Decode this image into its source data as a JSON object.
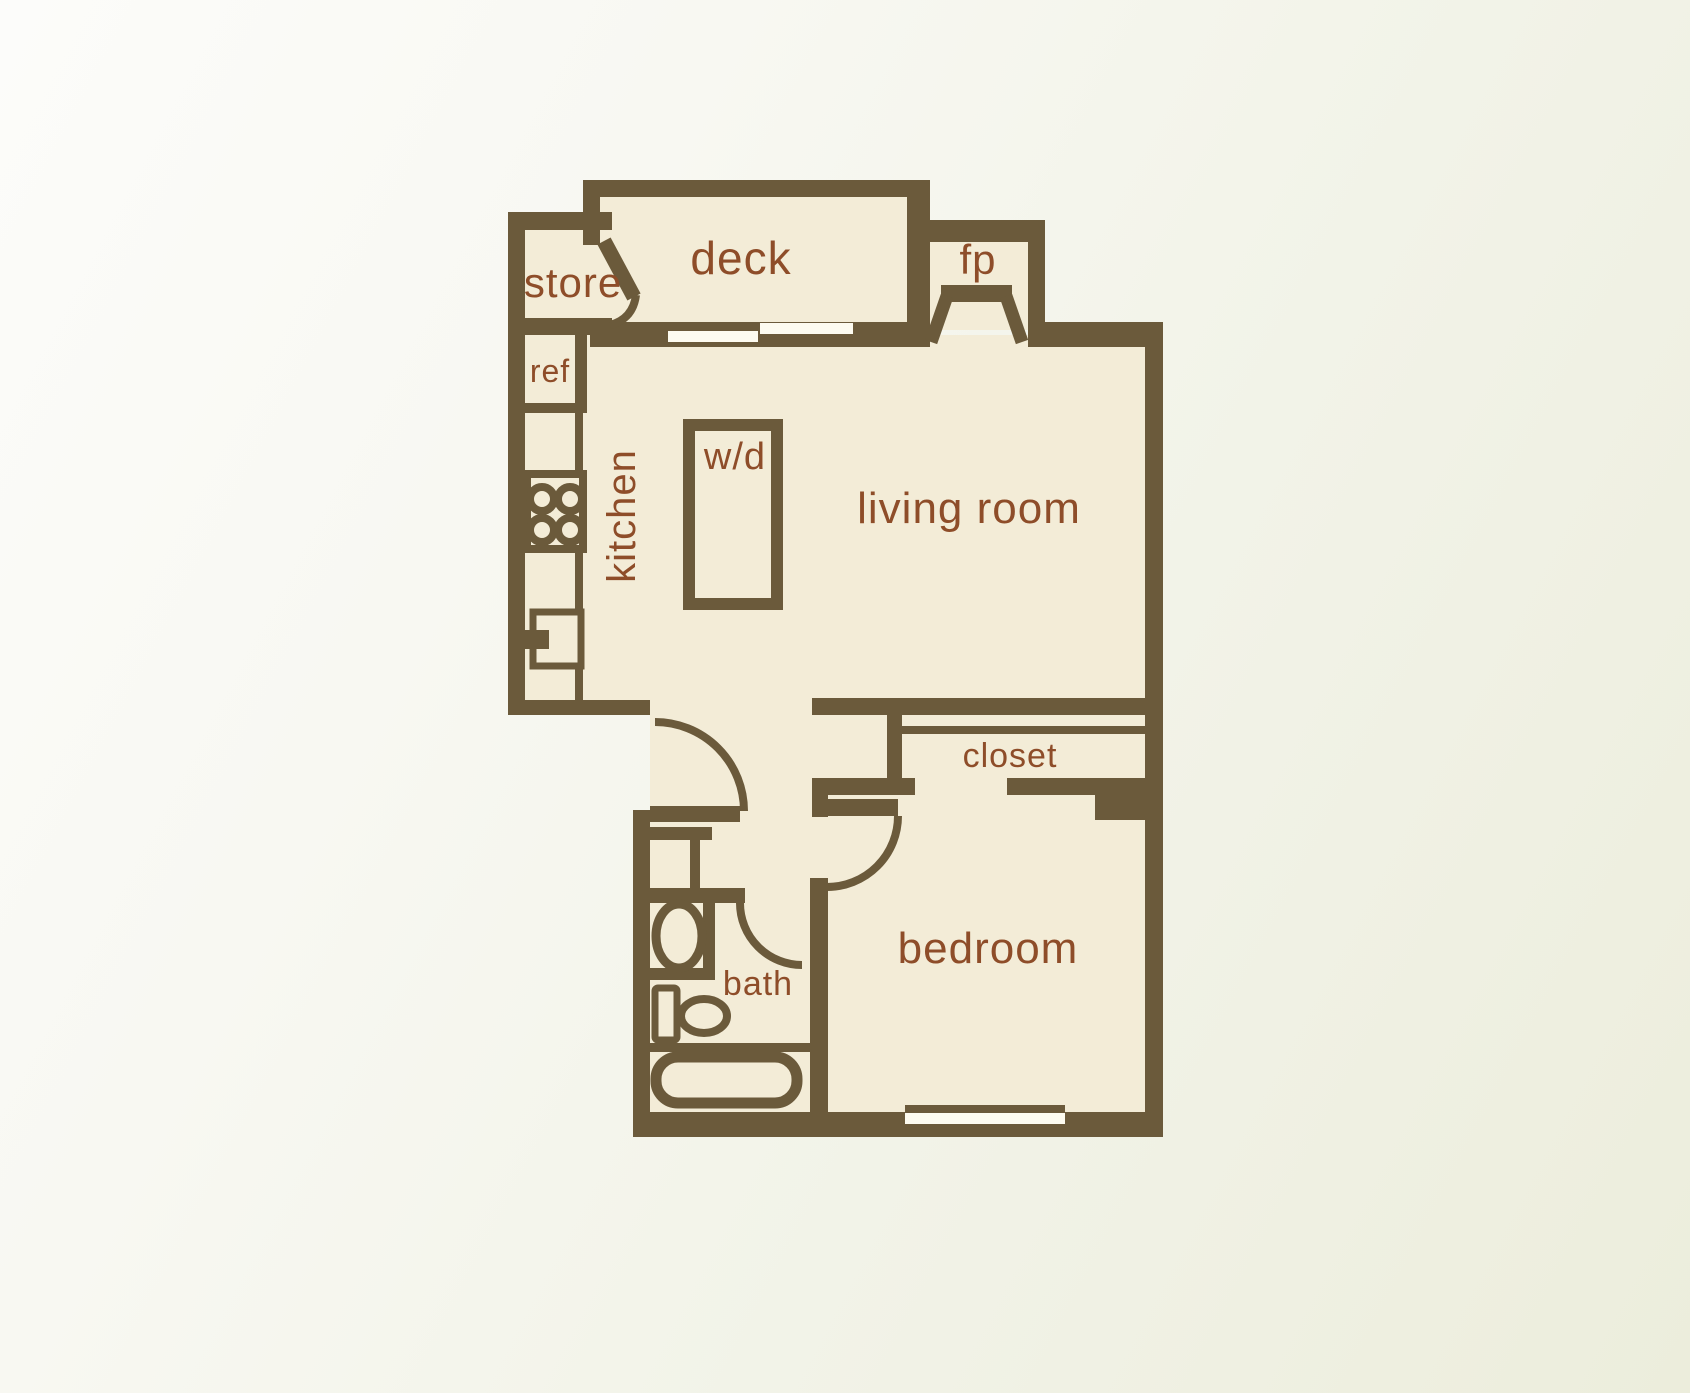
{
  "title": "one-bedroom apartment floor plan",
  "palette": {
    "wall": "#6b5a3b",
    "floor": "#f3ecd7",
    "label": "#8e4d29",
    "slit": "#fdfbf0",
    "bg_start": "#fcfcfa",
    "bg_end": "#eceddc"
  },
  "canvas": {
    "width": 1690,
    "height": 1393
  },
  "rooms": [
    {
      "id": "label-store",
      "text": "store",
      "x": 573,
      "y": 297,
      "fs": 42,
      "rot": 0
    },
    {
      "id": "label-deck",
      "text": "deck",
      "x": 741,
      "y": 274,
      "fs": 46,
      "rot": 0
    },
    {
      "id": "label-fp",
      "text": "fp",
      "x": 978,
      "y": 274,
      "fs": 42,
      "rot": 0
    },
    {
      "id": "label-ref",
      "text": "ref",
      "x": 550,
      "y": 382,
      "fs": 32,
      "rot": 0
    },
    {
      "id": "label-kitchen",
      "text": "kitchen",
      "x": 635,
      "y": 516,
      "fs": 40,
      "rot": -90
    },
    {
      "id": "label-wd",
      "text": "w/d",
      "x": 735,
      "y": 469,
      "fs": 38,
      "rot": 0
    },
    {
      "id": "label-living-room",
      "text": "living room",
      "x": 969,
      "y": 523,
      "fs": 44,
      "rot": 0
    },
    {
      "id": "label-closet",
      "text": "closet",
      "x": 1010,
      "y": 767,
      "fs": 34,
      "rot": 0
    },
    {
      "id": "label-bedroom",
      "text": "bedroom",
      "x": 988,
      "y": 963,
      "fs": 44,
      "rot": 0
    },
    {
      "id": "label-bath",
      "text": "bath",
      "x": 758,
      "y": 995,
      "fs": 34,
      "rot": 0
    }
  ],
  "floors": [
    {
      "id": "deck-floor",
      "x": 595,
      "y": 190,
      "w": 320,
      "h": 140
    },
    {
      "id": "store-floor",
      "x": 518,
      "y": 222,
      "w": 94,
      "h": 108
    },
    {
      "id": "kitchen-column-floor",
      "x": 518,
      "y": 325,
      "w": 65,
      "h": 385
    },
    {
      "id": "fireplace-floor",
      "x": 920,
      "y": 232,
      "w": 115,
      "h": 98
    },
    {
      "id": "main-floor",
      "x": 583,
      "y": 335,
      "w": 570,
      "h": 373
    },
    {
      "id": "hall-bath-floor",
      "x": 650,
      "y": 708,
      "w": 170,
      "h": 412
    },
    {
      "id": "bedroom-floor",
      "x": 818,
      "y": 708,
      "w": 335,
      "h": 412
    },
    {
      "id": "door-nook-floor",
      "x": 808,
      "y": 817,
      "w": 24,
      "h": 62
    }
  ],
  "walls": [
    {
      "id": "wall-left",
      "x": 508,
      "y": 212,
      "w": 17,
      "h": 503
    },
    {
      "id": "wall-store-top",
      "x": 508,
      "y": 212,
      "w": 104,
      "h": 18
    },
    {
      "id": "wall-store-bottom",
      "x": 508,
      "y": 318,
      "w": 104,
      "h": 17
    },
    {
      "id": "wall-ref-right",
      "x": 575,
      "y": 318,
      "w": 12,
      "h": 95
    },
    {
      "id": "wall-ref-bottom",
      "x": 508,
      "y": 403,
      "w": 79,
      "h": 10
    },
    {
      "id": "counter-edge",
      "x": 575,
      "y": 413,
      "w": 8,
      "h": 292
    },
    {
      "id": "wall-kitchen-bottom",
      "x": 508,
      "y": 700,
      "w": 142,
      "h": 15
    },
    {
      "id": "wall-deck-top",
      "x": 583,
      "y": 180,
      "w": 347,
      "h": 17
    },
    {
      "id": "wall-deck-left",
      "x": 583,
      "y": 180,
      "w": 17,
      "h": 65
    },
    {
      "id": "wall-deck-right",
      "x": 907,
      "y": 197,
      "w": 23,
      "h": 150
    },
    {
      "id": "wall-slider",
      "x": 590,
      "y": 322,
      "w": 340,
      "h": 25
    },
    {
      "id": "wall-fireplace-top",
      "x": 907,
      "y": 220,
      "w": 138,
      "h": 22
    },
    {
      "id": "wall-fireplace-right",
      "x": 1028,
      "y": 242,
      "w": 17,
      "h": 105
    },
    {
      "id": "wall-top-right",
      "x": 1028,
      "y": 322,
      "w": 135,
      "h": 25
    },
    {
      "id": "wall-right",
      "x": 1145,
      "y": 322,
      "w": 18,
      "h": 815
    },
    {
      "id": "wall-livingroom-bottom",
      "x": 812,
      "y": 698,
      "w": 351,
      "h": 17
    },
    {
      "id": "wall-closet-left-end",
      "x": 887,
      "y": 715,
      "w": 15,
      "h": 80
    },
    {
      "id": "closet-track",
      "x": 902,
      "y": 726,
      "w": 243,
      "h": 8
    },
    {
      "id": "wall-closet-bottom-left",
      "x": 812,
      "y": 778,
      "w": 103,
      "h": 17
    },
    {
      "id": "wall-closet-left-tab",
      "x": 812,
      "y": 795,
      "w": 16,
      "h": 22
    },
    {
      "id": "wall-closet-bottom-right",
      "x": 1007,
      "y": 778,
      "w": 140,
      "h": 17
    },
    {
      "id": "wall-closet-end-block",
      "x": 1095,
      "y": 778,
      "w": 52,
      "h": 42
    },
    {
      "id": "bedroom-door-leaf",
      "x": 826,
      "y": 799,
      "w": 72,
      "h": 17
    },
    {
      "id": "wall-bedroom-left",
      "x": 810,
      "y": 878,
      "w": 18,
      "h": 259
    },
    {
      "id": "wall-bath-left",
      "x": 633,
      "y": 810,
      "w": 17,
      "h": 327
    },
    {
      "id": "wall-bath-top",
      "x": 650,
      "y": 806,
      "w": 90,
      "h": 16
    },
    {
      "id": "vanity-counter-top",
      "x": 650,
      "y": 827,
      "w": 62,
      "h": 13
    },
    {
      "id": "vanity-divider",
      "x": 690,
      "y": 840,
      "w": 10,
      "h": 50
    },
    {
      "id": "wall-bath-mid",
      "x": 650,
      "y": 888,
      "w": 95,
      "h": 15
    },
    {
      "id": "vanity-right",
      "x": 703,
      "y": 903,
      "w": 12,
      "h": 75
    },
    {
      "id": "vanity-bottom",
      "x": 650,
      "y": 968,
      "w": 65,
      "h": 12
    },
    {
      "id": "toilet-divider",
      "x": 648,
      "y": 1043,
      "w": 162,
      "h": 9
    },
    {
      "id": "wall-bottom",
      "x": 633,
      "y": 1112,
      "w": 530,
      "h": 25
    },
    {
      "id": "window-inner-line",
      "x": 905,
      "y": 1105,
      "w": 160,
      "h": 8
    }
  ],
  "slits": [
    {
      "id": "slider-panel-1",
      "x": 668,
      "y": 331,
      "w": 90,
      "h": 11
    },
    {
      "id": "slider-panel-2",
      "x": 760,
      "y": 323,
      "w": 93,
      "h": 11
    },
    {
      "id": "bedroom-window",
      "x": 905,
      "y": 1113,
      "w": 160,
      "h": 11
    }
  ],
  "stroked_boxes": [
    {
      "id": "stove-box",
      "x": 527,
      "y": 474,
      "w": 56,
      "h": 75,
      "sw": 8,
      "rx": 0
    },
    {
      "id": "kitchen-sink-box",
      "x": 533,
      "y": 612,
      "w": 48,
      "h": 54,
      "sw": 7,
      "rx": 0
    },
    {
      "id": "washer-dryer-box",
      "x": 689,
      "y": 425,
      "w": 88,
      "h": 179,
      "sw": 12,
      "rx": 0
    },
    {
      "id": "toilet-tank",
      "x": 655,
      "y": 988,
      "w": 22,
      "h": 52,
      "sw": 7,
      "rx": 3
    },
    {
      "id": "bathtub",
      "x": 656,
      "y": 1057,
      "w": 141,
      "h": 46,
      "sw": 11,
      "rx": 22
    }
  ],
  "filled_rects": [
    {
      "id": "sink-faucet",
      "x": 521,
      "y": 630,
      "w": 28,
      "h": 19
    }
  ],
  "burners": [
    {
      "id": "stove-burner-1",
      "cx": 542,
      "cy": 499,
      "r": 12
    },
    {
      "id": "stove-burner-2",
      "cx": 570,
      "cy": 499,
      "r": 12
    },
    {
      "id": "stove-burner-3",
      "cx": 542,
      "cy": 530,
      "r": 12
    },
    {
      "id": "stove-burner-4",
      "cx": 570,
      "cy": 530,
      "r": 12
    }
  ],
  "ellipses": [
    {
      "id": "vanity-sink-oval",
      "cx": 679,
      "cy": 936,
      "rx": 23,
      "ry": 32,
      "sw": 9
    },
    {
      "id": "toilet-bowl",
      "cx": 704,
      "cy": 1016,
      "rx": 23,
      "ry": 17,
      "sw": 8
    }
  ],
  "paths": [
    {
      "id": "entry-door-arc",
      "d": "M 655 722 A 89 89 0 0 1 744 811",
      "sw": 8,
      "fill": "none"
    },
    {
      "id": "bedroom-door-arc",
      "d": "M 898 816 A 71 71 0 0 1 827 887",
      "sw": 8,
      "fill": "none"
    },
    {
      "id": "bath-door-arc",
      "d": "M 740 903 A 62 62 0 0 0 802 965",
      "sw": 8,
      "fill": "none"
    },
    {
      "id": "store-door-panel",
      "d": "M 604 241 L 634 297",
      "sw": 15,
      "fill": "none"
    },
    {
      "id": "store-door-arc",
      "d": "M 636 295 Q 633 319 610 325",
      "sw": 8,
      "fill": "none"
    },
    {
      "id": "fireplace-hearth-bar",
      "d": "M 941 285 L 1012 285 L 1012 302 L 941 302 Z",
      "sw": 0,
      "fill": "wall"
    },
    {
      "id": "fireplace-leg-left",
      "d": "M 947 296 L 931 342",
      "sw": 13,
      "fill": "none"
    },
    {
      "id": "fireplace-leg-right",
      "d": "M 1006 296 L 1022 342",
      "sw": 13,
      "fill": "none"
    }
  ]
}
